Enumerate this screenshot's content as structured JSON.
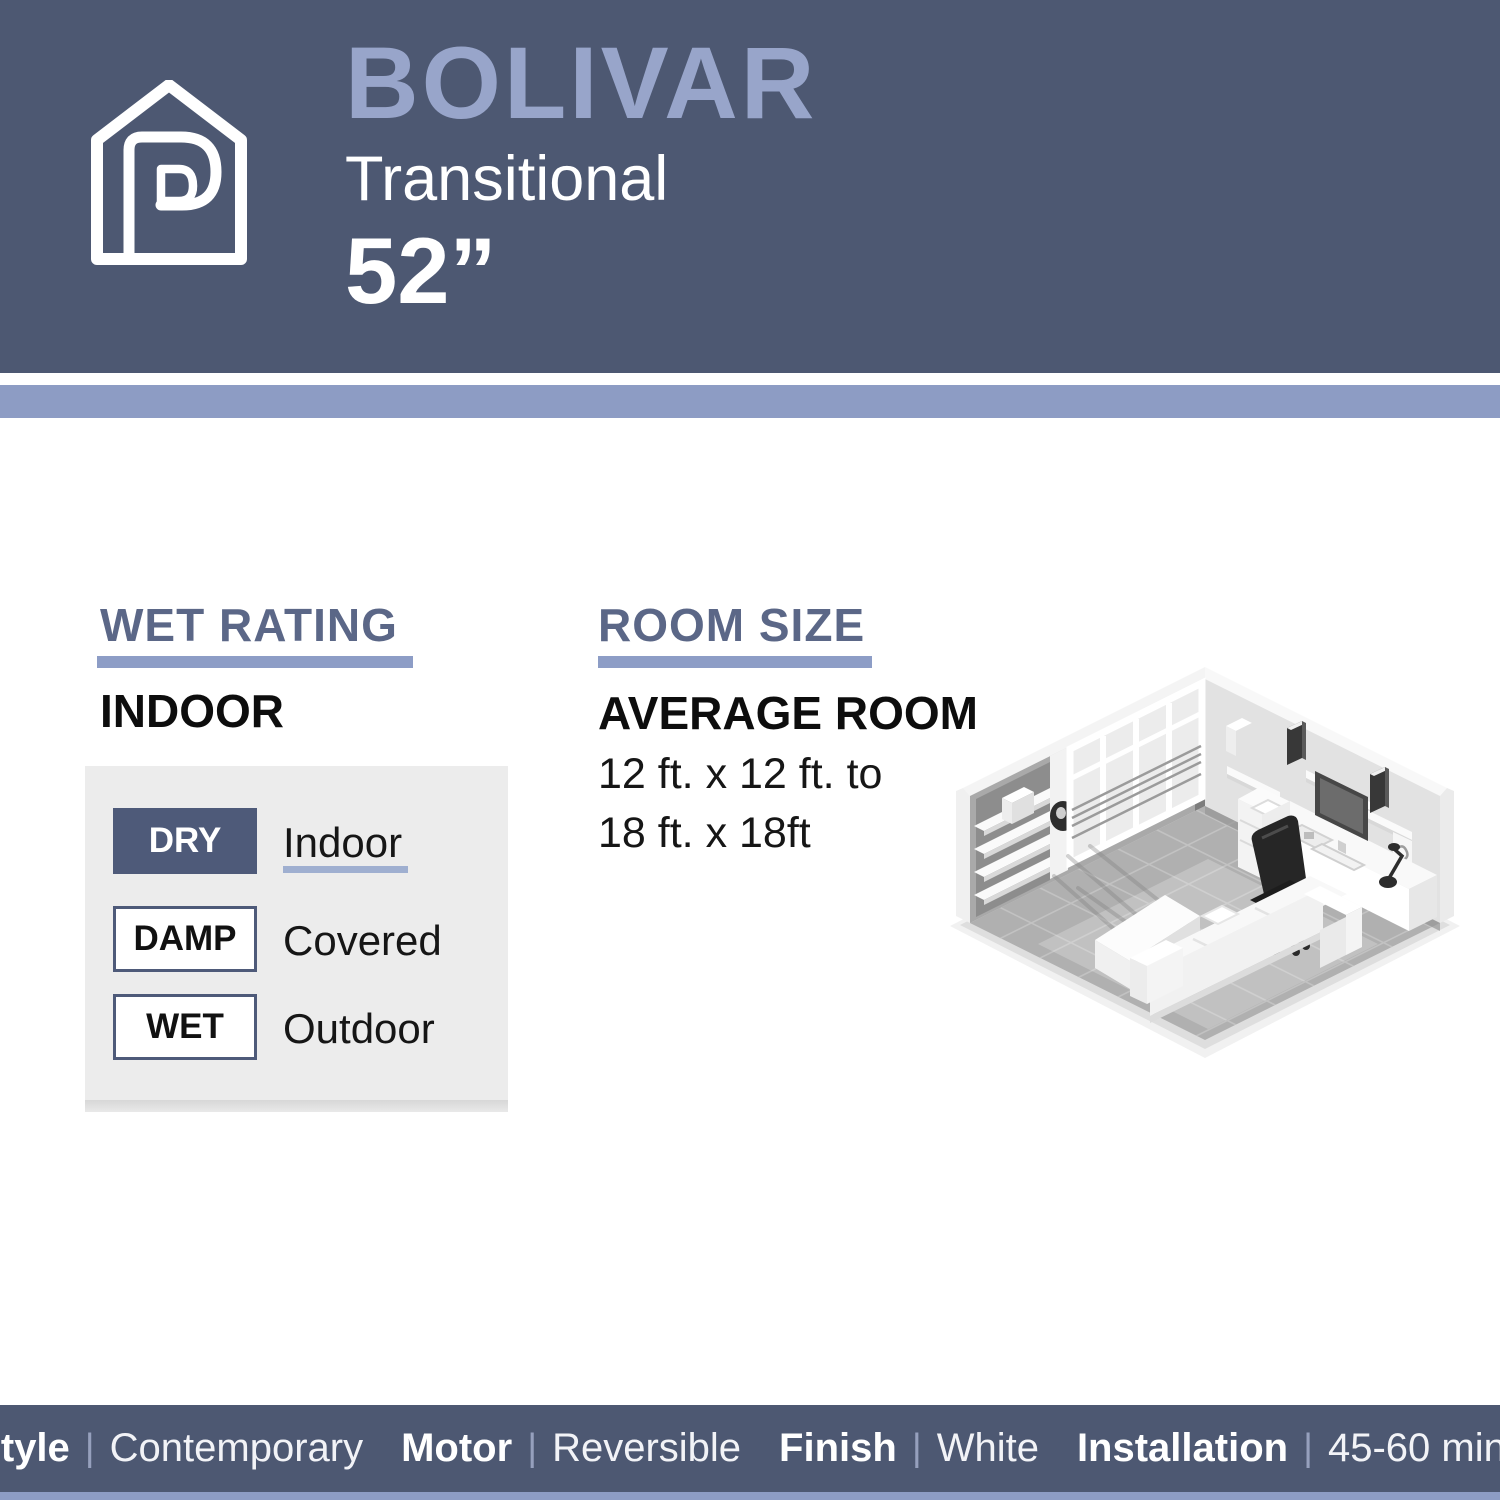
{
  "header": {
    "product_name": "BOLIVAR",
    "style_name": "Transitional",
    "size": "52”",
    "bg_color": "#4d5872",
    "product_name_color": "#98a5ca",
    "accent_stripe_color": "#8d9cc4"
  },
  "wet_rating": {
    "title": "WET RATING",
    "value": "INDOOR",
    "rows": [
      {
        "chip": "DRY",
        "label": "Indoor",
        "active": true
      },
      {
        "chip": "DAMP",
        "label": "Covered",
        "active": false
      },
      {
        "chip": "WET",
        "label": "Outdoor",
        "active": false
      }
    ],
    "active_chip_color": "#4e5a79"
  },
  "room_size": {
    "title": "ROOM SIZE",
    "heading": "AVERAGE ROOM",
    "line1": "12 ft. x 12 ft. to",
    "line2": "18 ft. x 18ft"
  },
  "footer": {
    "divider": "|",
    "items": [
      {
        "label": "Style",
        "value": "Contemporary"
      },
      {
        "label": "Motor",
        "value": "Reversible"
      },
      {
        "label": "Finish",
        "value": "White"
      },
      {
        "label": "Installation",
        "value": "45-60 mins"
      }
    ]
  }
}
